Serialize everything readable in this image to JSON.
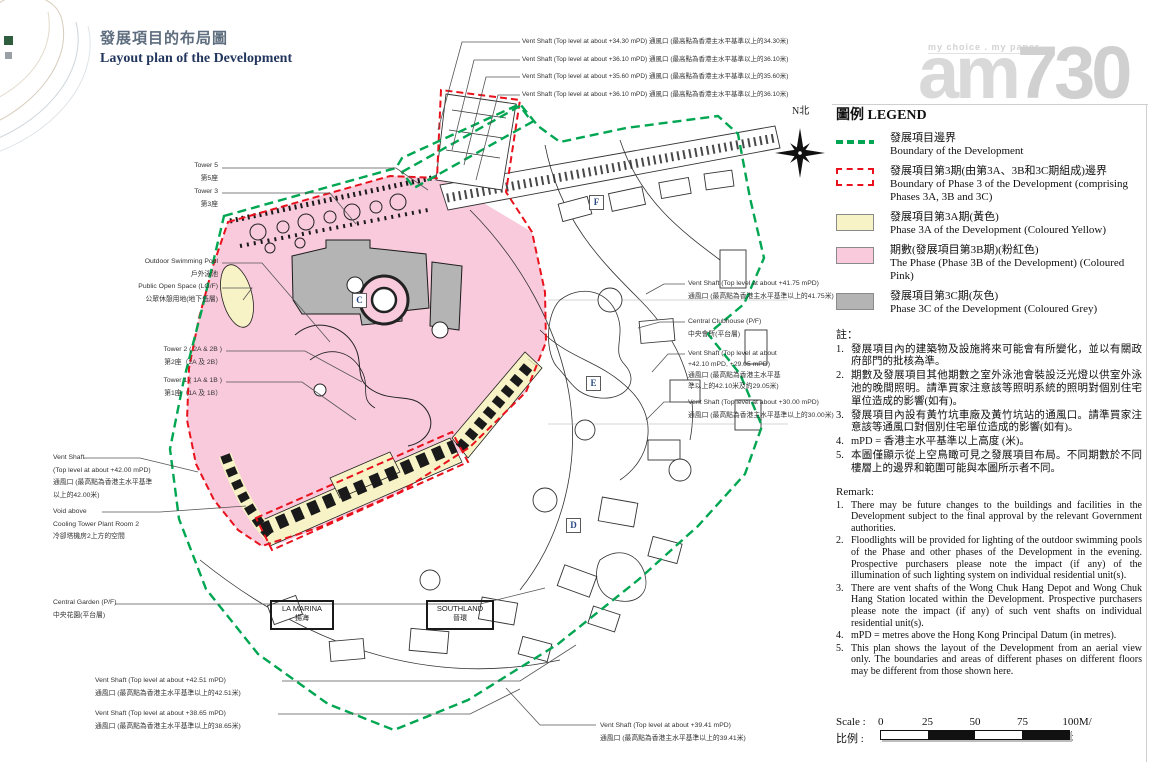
{
  "title": {
    "zh": "發展項目的布局圖",
    "en": "Layout plan of the Development"
  },
  "watermark": {
    "tagline": "my choice . my paper",
    "logo_am": "am",
    "logo_num": "730"
  },
  "compass": {
    "label": "N北"
  },
  "colors": {
    "boundary_green": "#00a651",
    "phase3_red": "#e8111c",
    "phase3a_yellow": "#f7f3c6",
    "phase3b_pink": "#f9cadb",
    "phase3c_grey": "#b4b4b4"
  },
  "legend": {
    "title": "圖例 LEGEND",
    "items": [
      {
        "swatch": "green-dashed-line",
        "zh": "發展項目邊界",
        "en": "Boundary of the Development"
      },
      {
        "swatch": "red-dashed-box",
        "zh": "發展項目第3期(由第3A、3B和3C期組成)邊界",
        "en": "Boundary of Phase 3 of the Development (comprising Phases 3A, 3B and 3C)"
      },
      {
        "swatch": "yellow-box",
        "zh": "發展項目第3A期(黃色)",
        "en": "Phase 3A of the Development (Coloured Yellow)"
      },
      {
        "swatch": "pink-box",
        "zh": "期數(發展項目第3B期)(粉紅色)",
        "en": "The Phase (Phase 3B of the Development) (Coloured Pink)"
      },
      {
        "swatch": "grey-box",
        "zh": "發展項目第3C期(灰色)",
        "en": "Phase 3C of the Development (Coloured Grey)"
      }
    ]
  },
  "notes_zh": {
    "heading": "註：",
    "items": [
      "發展項目內的建築物及設施將來可能會有所變化，並以有關政府部門的批核為準。",
      "期數及發展項目其他期數之室外泳池會裝設泛光燈以供室外泳池的晚間照明。請準買家注意該等照明系統的照明對個別住宅單位造成的影響(如有)。",
      "發展項目內設有黃竹坑車廠及黃竹坑站的通風口。請準買家注意該等通風口對個別住宅單位造成的影響(如有)。",
      "mPD = 香港主水平基準以上高度 (米)。",
      "本圖僅顯示從上空鳥瞰可見之發展項目布局。不同期數於不同樓層上的邊界和範圍可能與本圖所示者不同。"
    ]
  },
  "remarks_en": {
    "heading": "Remark:",
    "items": [
      "There may be future changes to the buildings and facilities in the Development subject to the final approval by the relevant Government authorities.",
      "Floodlights will be provided for lighting of the outdoor swimming pools of the Phase and other phases of the Development in the evening. Prospective purchasers please note the impact (if any) of the illumination of such lighting system on individual residential unit(s).",
      "There are vent shafts of the Wong Chuk Hang Depot and Wong Chuk Hang Station located within the Development. Prospective purchasers please note the impact (if any) of such vent shafts on individual residential unit(s).",
      "mPD = metres above the Hong Kong Principal Datum (in metres).",
      "This plan shows the layout of the Development from an aerial view only. The boundaries and areas of different phases on different floors may be different from those shown here."
    ]
  },
  "scale": {
    "label_en": "Scale :",
    "label_zh": "比例 :",
    "ticks": [
      "0",
      "25",
      "50",
      "75",
      "100M/米"
    ]
  },
  "map": {
    "top_callouts": [
      "Vent Shaft (Top level at about +34.30 mPD) 通風口 (最高點為香港主水平基準以上的34.30米)",
      "Vent Shaft (Top level at about +36.10 mPD) 通風口 (最高點為香港主水平基準以上的36.10米)",
      "Vent Shaft (Top level at about +35.60 mPD) 通風口 (最高點為香港主水平基準以上的35.60米)",
      "Vent Shaft (Top level at about +36.10 mPD) 通風口 (最高點為香港主水平基準以上的36.10米)"
    ],
    "labels_left": [
      {
        "lines": [
          "Tower 5",
          "第5座"
        ]
      },
      {
        "lines": [
          "Tower 3",
          "第3座"
        ]
      },
      {
        "lines": [
          "Outdoor Swimming Pool",
          "戶外泳池"
        ]
      },
      {
        "lines": [
          "Public Open Space (LG/F)",
          "公眾休憩用地(地下低層)"
        ]
      },
      {
        "lines": [
          "Tower 2 ( 2A & 2B )",
          "第2座（2A 及 2B）"
        ]
      },
      {
        "lines": [
          "Tower 1 ( 1A & 1B )",
          "第1座（1A 及 1B）"
        ]
      },
      {
        "lines": [
          "Vent Shaft",
          "(Top level at about +42.00 mPD)",
          "通風口 (最高點為香港主水平基準",
          "以上的42.00米)"
        ]
      },
      {
        "lines": [
          "Void above",
          "Cooling Tower Plant Room 2",
          "冷卻塔機房2上方的空間"
        ]
      },
      {
        "lines": [
          "Central Garden (P/F)",
          "中央花園(平台層)"
        ]
      },
      {
        "lines": [
          "Vent Shaft (Top level at about +42.51 mPD)",
          "通風口 (最高點為香港主水平基準以上的42.51米)"
        ]
      },
      {
        "lines": [
          "Vent Shaft (Top level at about +38.65 mPD)",
          "通風口 (最高點為香港主水平基準以上的38.65米)"
        ]
      }
    ],
    "labels_right": [
      {
        "lines": [
          "Vent Shaft (Top level at about +41.75 mPD)",
          "通風口 (最高點為香港主水平基準以上的41.75米)"
        ]
      },
      {
        "lines": [
          "Central Clubhouse (P/F)",
          "中央會所(平台層)"
        ]
      },
      {
        "lines": [
          "Vent Shaft (Top level at about",
          "+42.10 mPD, +29.05 mPD)",
          "通風口 (最高點為香港主水平基",
          "準以上的42.10米及約29.05米)"
        ]
      },
      {
        "lines": [
          "Vent Shaft (Top level at about +30.00 mPD)",
          "通風口 (最高點為香港主水平基準以上的30.00米)"
        ]
      }
    ],
    "label_bottom": {
      "lines": [
        "Vent Shaft (Top level at about +39.41 mPD)",
        "通風口 (最高點為香港主水平基準以上的39.41米)"
      ]
    },
    "markers": [
      "C",
      "D",
      "E",
      "F"
    ],
    "site_labels": [
      {
        "en": "LA MARINA",
        "zh": "揚海"
      },
      {
        "en": "SOUTHLAND",
        "zh": "晉環"
      }
    ]
  }
}
